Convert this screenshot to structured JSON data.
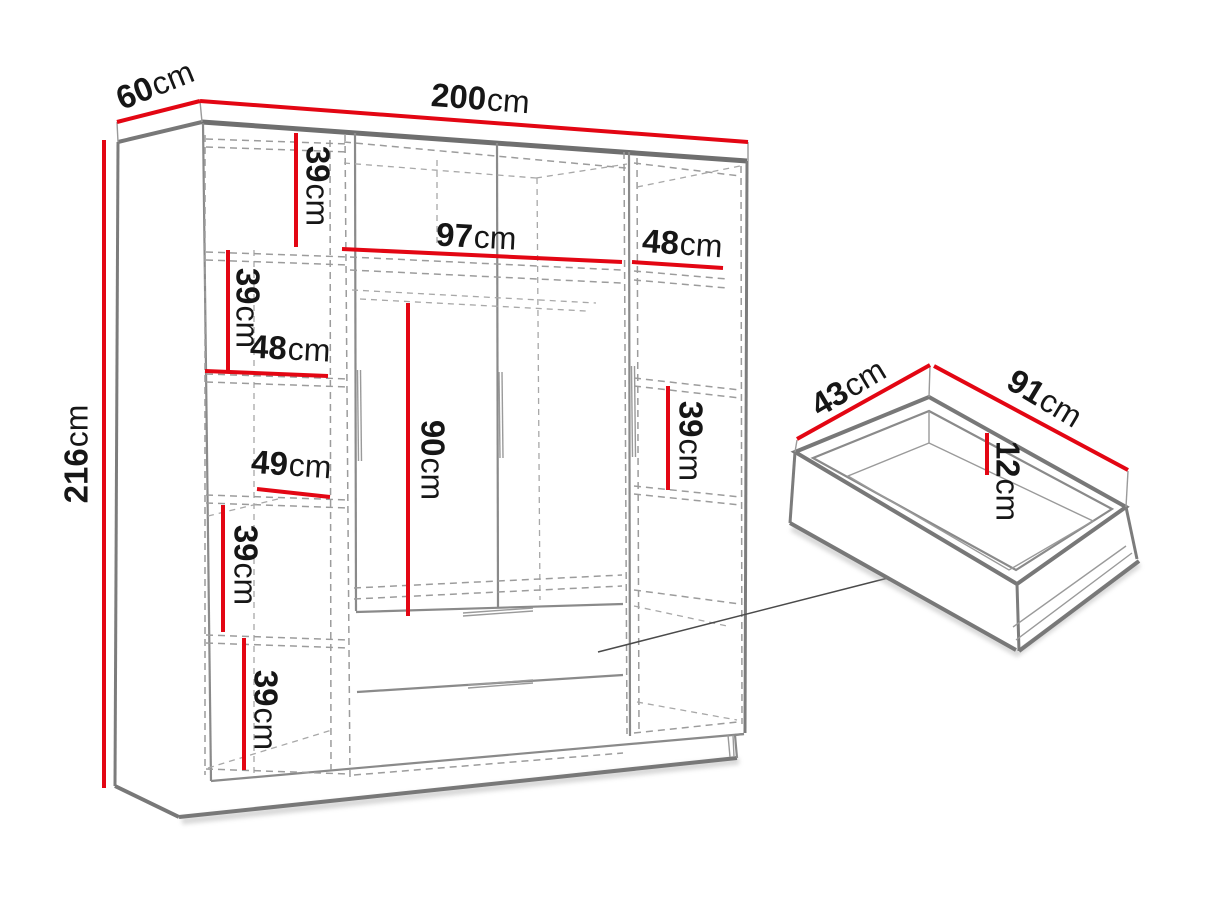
{
  "page": {
    "background": "#ffffff"
  },
  "colors": {
    "dimension_line": "#e30613",
    "outline_gray": "#7c7c7c",
    "dashed_gray": "#9c9c9c",
    "label_text": "#161616"
  },
  "labels": {
    "depth": {
      "value": "60",
      "unit": "cm"
    },
    "width": {
      "value": "200",
      "unit": "cm"
    },
    "height": {
      "value": "216",
      "unit": "cm"
    },
    "left_shelf_gap_1": {
      "value": "39",
      "unit": "cm"
    },
    "left_shelf_gap_2": {
      "value": "39",
      "unit": "cm"
    },
    "left_shelf_width_upper": {
      "value": "48",
      "unit": "cm"
    },
    "left_shelf_width_lower": {
      "value": "49",
      "unit": "cm"
    },
    "left_shelf_gap_3": {
      "value": "39",
      "unit": "cm"
    },
    "left_shelf_gap_4": {
      "value": "39",
      "unit": "cm"
    },
    "middle_top_shelf_width": {
      "value": "97",
      "unit": "cm"
    },
    "middle_hanging_height": {
      "value": "90",
      "unit": "cm"
    },
    "right_shelf_width": {
      "value": "48",
      "unit": "cm"
    },
    "right_shelf_gap": {
      "value": "39",
      "unit": "cm"
    },
    "drawer_depth": {
      "value": "43",
      "unit": "cm"
    },
    "drawer_width": {
      "value": "91",
      "unit": "cm"
    },
    "drawer_height": {
      "value": "12",
      "unit": "cm"
    }
  }
}
